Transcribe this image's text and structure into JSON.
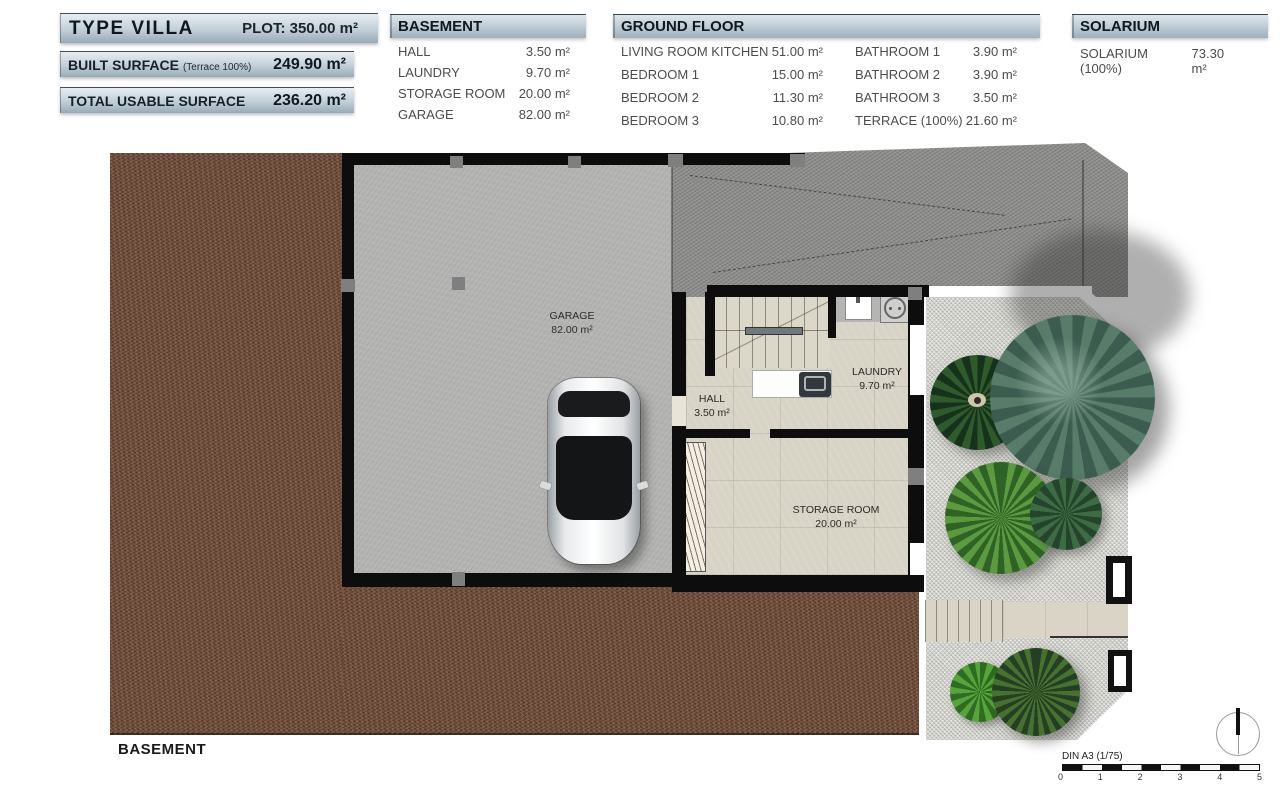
{
  "summary": {
    "type_label": "TYPE VILLA",
    "plot_value": "PLOT: 350.00 m²",
    "built_label": "BUILT SURFACE",
    "built_note": "(Terrace 100%)",
    "built_value": "249.90 m²",
    "usable_label": "TOTAL USABLE SURFACE",
    "usable_value": "236.20 m²"
  },
  "legend": {
    "basement": {
      "title": "BASEMENT",
      "rows": [
        {
          "label": "HALL",
          "value": "3.50 m²"
        },
        {
          "label": "LAUNDRY",
          "value": "9.70 m²"
        },
        {
          "label": "STORAGE ROOM",
          "value": "20.00 m²"
        },
        {
          "label": "GARAGE",
          "value": "82.00 m²"
        }
      ]
    },
    "ground_floor": {
      "title": "GROUND FLOOR",
      "left_rows": [
        {
          "label": "LIVING ROOM KITCHEN",
          "value": "51.00 m²"
        },
        {
          "label": "BEDROOM 1",
          "value": "15.00 m²"
        },
        {
          "label": "BEDROOM 2",
          "value": "11.30 m²"
        },
        {
          "label": "BEDROOM 3",
          "value": "10.80 m²"
        }
      ],
      "right_rows": [
        {
          "label": "BATHROOM 1",
          "value": "3.90 m²"
        },
        {
          "label": "BATHROOM 2",
          "value": "3.90 m²"
        },
        {
          "label": "BATHROOM 3",
          "value": "3.50 m²"
        },
        {
          "label": "TERRACE (100%)",
          "value": "21.60 m²"
        }
      ]
    },
    "solarium": {
      "title": "SOLARIUM",
      "rows": [
        {
          "label": "SOLARIUM (100%)",
          "value": "73.30 m²"
        }
      ]
    }
  },
  "plan": {
    "rooms": {
      "garage": {
        "name": "GARAGE",
        "area": "82.00 m²"
      },
      "hall": {
        "name": "HALL",
        "area": "3.50 m²"
      },
      "laundry": {
        "name": "LAUNDRY",
        "area": "9.70 m²"
      },
      "storage": {
        "name": "STORAGE ROOM",
        "area": "20.00 m²"
      }
    },
    "floor_label": "BASEMENT",
    "scale": {
      "label": "DIN A3 (1/75)",
      "ticks": [
        "0",
        "1",
        "2",
        "3",
        "4",
        "5"
      ]
    }
  },
  "colors": {
    "header_bar": "#9cb0bd",
    "wall": "#0d0d0d",
    "dirt": "#6b4836",
    "concrete": "#b4b4b2",
    "gravel": "#dadad4",
    "ramp": "#8f8f8d"
  }
}
